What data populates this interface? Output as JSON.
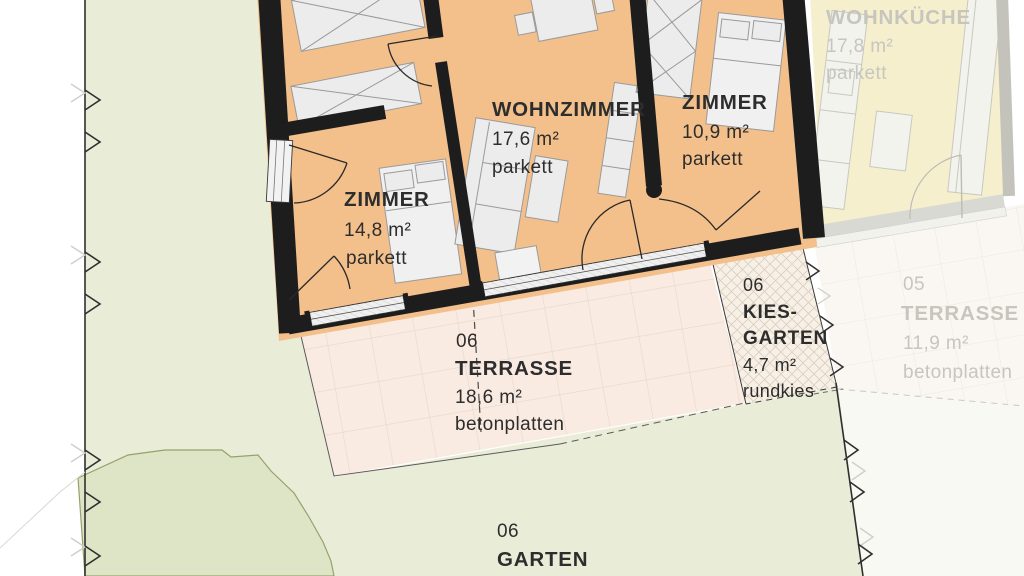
{
  "plan": {
    "unit06": {
      "wohnzimmer": {
        "name": "WOHNZIMMER",
        "area": "17,6 m²",
        "floor": "parkett"
      },
      "zimmer_left": {
        "name": "ZIMMER",
        "area": "14,8 m²",
        "floor": "parkett"
      },
      "zimmer_right": {
        "name": "ZIMMER",
        "area": "10,9 m²",
        "floor": "parkett"
      },
      "terrasse": {
        "number": "06",
        "name": "TERRASSE",
        "area": "18,6 m²",
        "floor": "betonplatten"
      },
      "kiesgarten": {
        "number": "06",
        "name_line1": "KIES-",
        "name_line2": "GARTEN",
        "area": "4,7 m²",
        "floor": "rundkies"
      },
      "garten": {
        "number": "06",
        "name": "GARTEN"
      }
    },
    "unit05": {
      "wohnkueche": {
        "name": "WOHNKÜCHE",
        "area": "17,8 m²",
        "floor": "parkett"
      },
      "terrasse": {
        "number": "05",
        "name": "TERRASSE",
        "area": "11,9 m²",
        "floor": "betonplatten"
      }
    },
    "colors": {
      "parquet": "#f3c08b",
      "neighbor_floor": "#f6efce",
      "garden": "#e9edd8",
      "garden_dark": "#dee5c7",
      "terrace": "#f9ebe2",
      "terrace_faded": "#faf6f1",
      "gravel": "#f7f0e7",
      "outside_neighbor": "#f8f9f2",
      "wall": "#1d1d1d",
      "wall_faded": "#c3c3bb",
      "text": "#2d2d2d",
      "text_faded": "#c6c6bf"
    }
  }
}
